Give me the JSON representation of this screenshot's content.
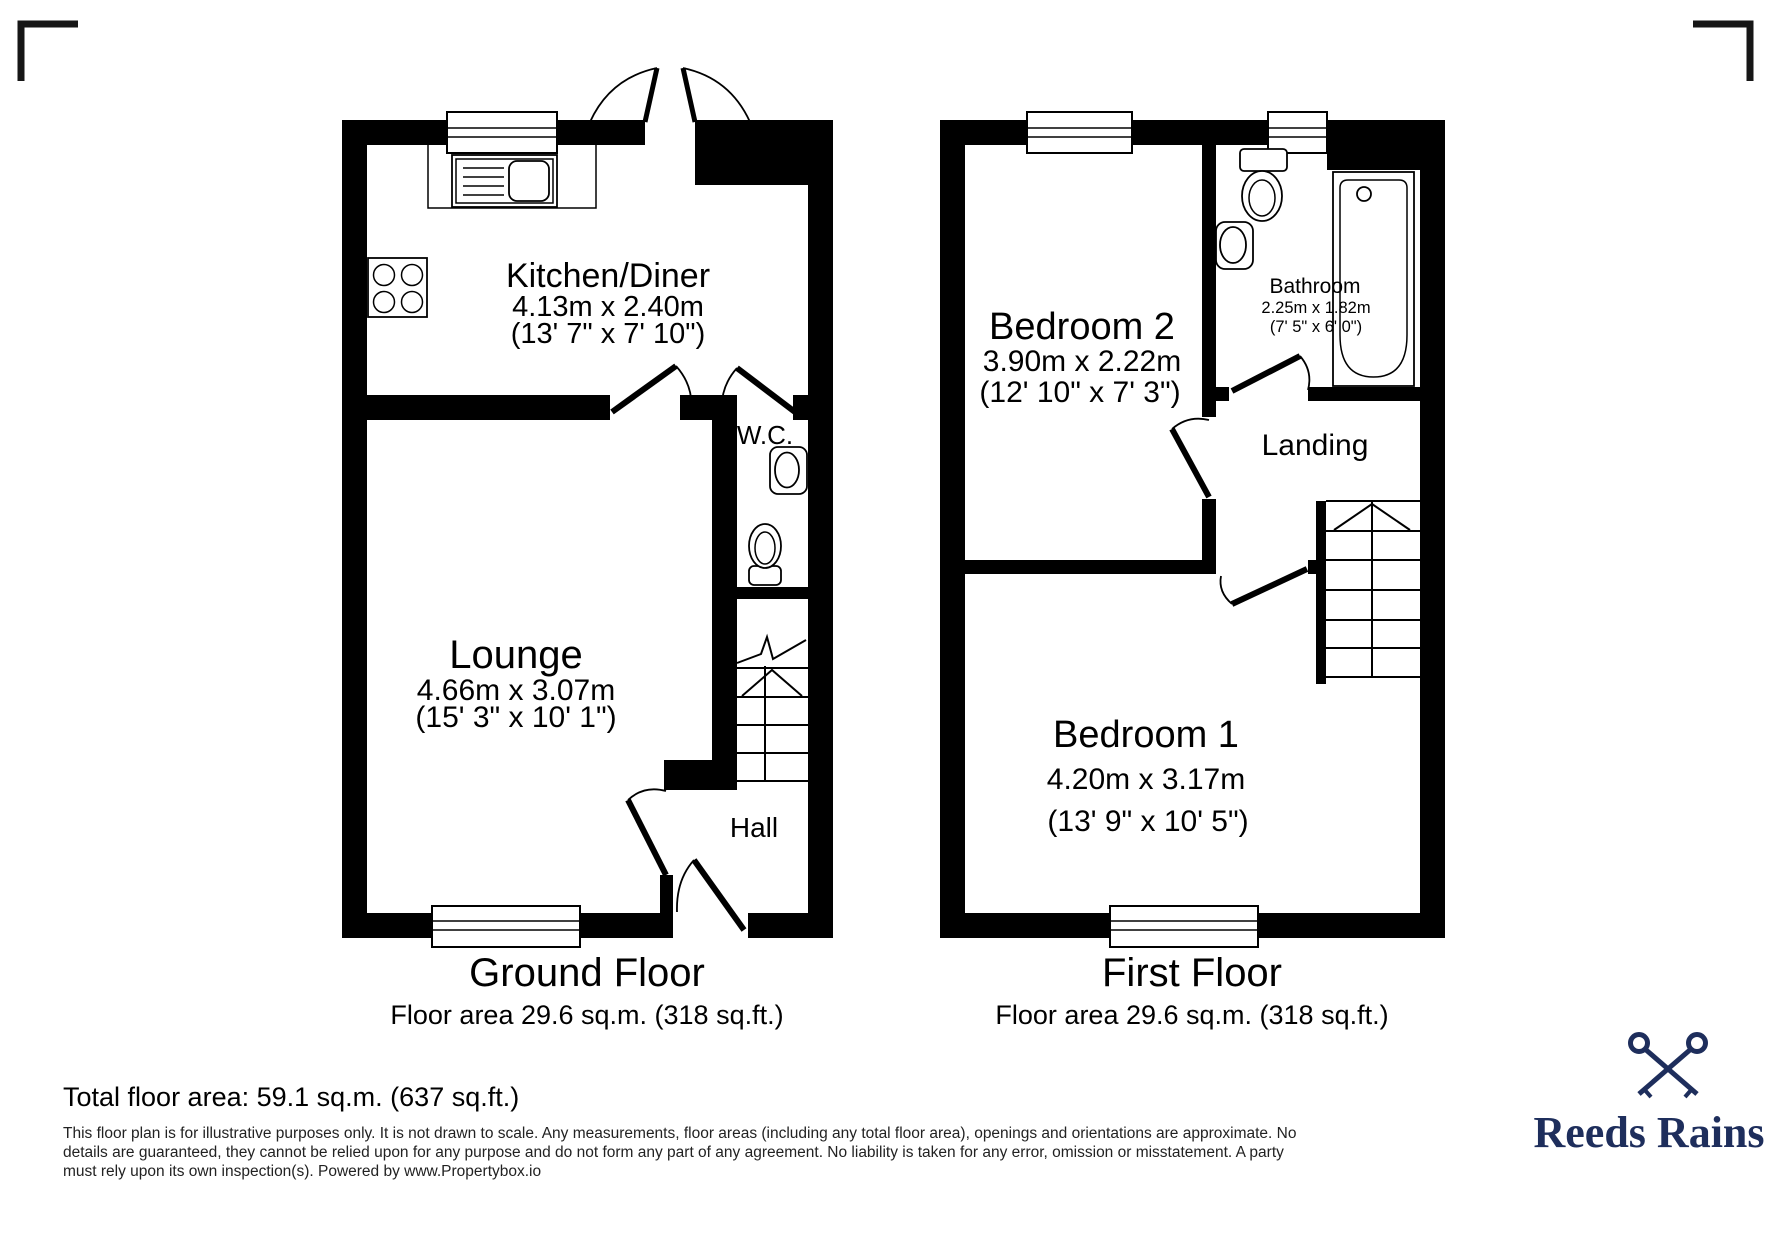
{
  "colors": {
    "plan": "#000000",
    "brand_navy": "#1e2e5c"
  },
  "ground_floor": {
    "title": "Ground Floor",
    "area_line": "Floor area 29.6 sq.m. (318 sq.ft.)",
    "kitchen_name": "Kitchen/Diner",
    "kitchen_metric": "4.13m x 2.40m",
    "kitchen_imperial": "(13' 7\" x 7' 10\")",
    "lounge_name": "Lounge",
    "lounge_metric": "4.66m x 3.07m",
    "lounge_imperial": "(15' 3\" x 10' 1\")",
    "wc_name": "W.C.",
    "hall_name": "Hall"
  },
  "first_floor": {
    "title": "First Floor",
    "area_line": "Floor area 29.6 sq.m. (318 sq.ft.)",
    "bedroom2_name": "Bedroom 2",
    "bedroom2_metric": "3.90m x 2.22m",
    "bedroom2_imperial": "(12' 10\" x 7' 3\")",
    "bathroom_name": "Bathroom",
    "bathroom_metric": "2.25m x 1.82m",
    "bathroom_imperial": "(7' 5\" x 6' 0\")",
    "landing_name": "Landing",
    "bedroom1_name": "Bedroom 1",
    "bedroom1_metric": "4.20m x 3.17m",
    "bedroom1_imperial": "(13' 9\" x 10' 5\")"
  },
  "footer": {
    "total_area": "Total floor area: 59.1 sq.m. (637 sq.ft.)",
    "disclaimer_1": "This floor plan is for illustrative purposes only. It is not drawn to scale. Any measurements, floor areas (including any total floor area), openings and orientations are approximate. No",
    "disclaimer_2": "details are guaranteed, they cannot be relied upon for any purpose and do not form any part of any agreement. No liability is taken for any error, omission or misstatement. A party",
    "disclaimer_3": "must rely upon its own inspection(s). Powered by www.Propertybox.io",
    "brand_name": "Reeds Rains"
  }
}
